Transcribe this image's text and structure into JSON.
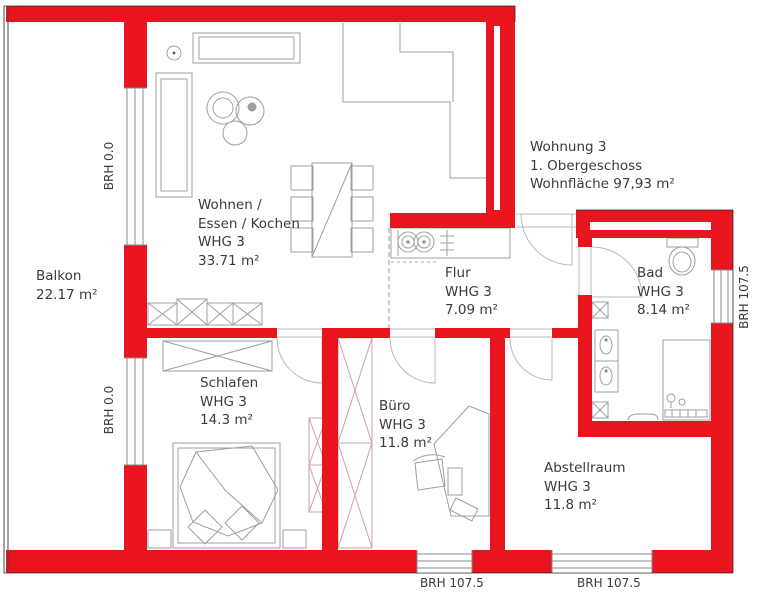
{
  "plan_title": "Floor plan Wohnung 3 – 1. Obergeschoss",
  "colors": {
    "wall_red": "#e8141e",
    "furniture_gray": "#9aa0a4",
    "closet_pink": "#d4a0a0",
    "text": "#3b3b3b"
  },
  "title_block": {
    "line1": "Wohnung 3",
    "line2": "1. Obergeschoss",
    "line3": "Wohnfläche 97,93 m²"
  },
  "rooms": {
    "balkon": {
      "name": "Balkon",
      "area": "22.17 m²"
    },
    "wohnen": {
      "name_line1": "Wohnen /",
      "name_line2": "Essen / Kochen",
      "unit": "WHG 3",
      "area": "33.71 m²"
    },
    "flur": {
      "name": "Flur",
      "unit": "WHG 3",
      "area": "7.09 m²"
    },
    "bad": {
      "name": "Bad",
      "unit": "WHG 3",
      "area": "8.14 m²"
    },
    "schlafen": {
      "name": "Schlafen",
      "unit": "WHG 3",
      "area": "14.3 m²"
    },
    "buero": {
      "name": "Büro",
      "unit": "WHG 3",
      "area": "11.8 m²"
    },
    "abstellraum": {
      "name": "Abstellraum",
      "unit": "WHG 3",
      "area": "11.8 m²"
    }
  },
  "sill_labels": {
    "left_top": "BRH 0.0",
    "left_bottom": "BRH 0.0",
    "right": "BRH 107.5",
    "bottom_left": "BRH 107.5",
    "bottom_right": "BRH 107.5"
  }
}
